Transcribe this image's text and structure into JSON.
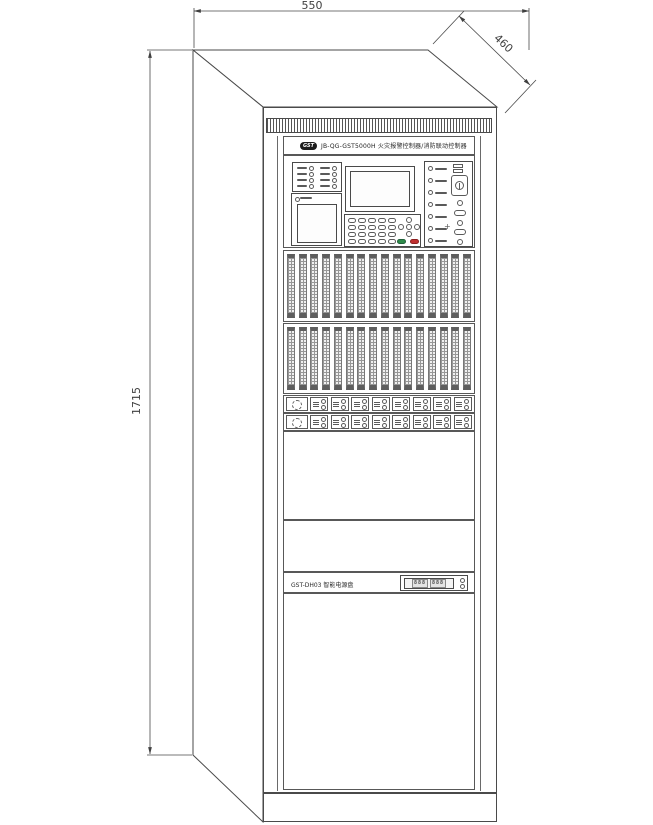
{
  "dimensions": {
    "width": "550",
    "depth": "460",
    "height": "1715"
  },
  "header": {
    "logo": "GST",
    "model": "JB-QG-GST5000H 火灾报警控制器/消防联动控制器"
  },
  "power_unit": {
    "label": "GST-DH03 智能电源盘",
    "display_left": "888",
    "display_right": "888"
  },
  "counts": {
    "left_led_cells": 8,
    "keypad_keys": 20,
    "right_led_rows": 7,
    "loop_cards": 8,
    "relay_modules": 8
  },
  "colors": {
    "line": "#4a4a4a",
    "green_key": "#2e8b4a",
    "red_key": "#c03030"
  }
}
